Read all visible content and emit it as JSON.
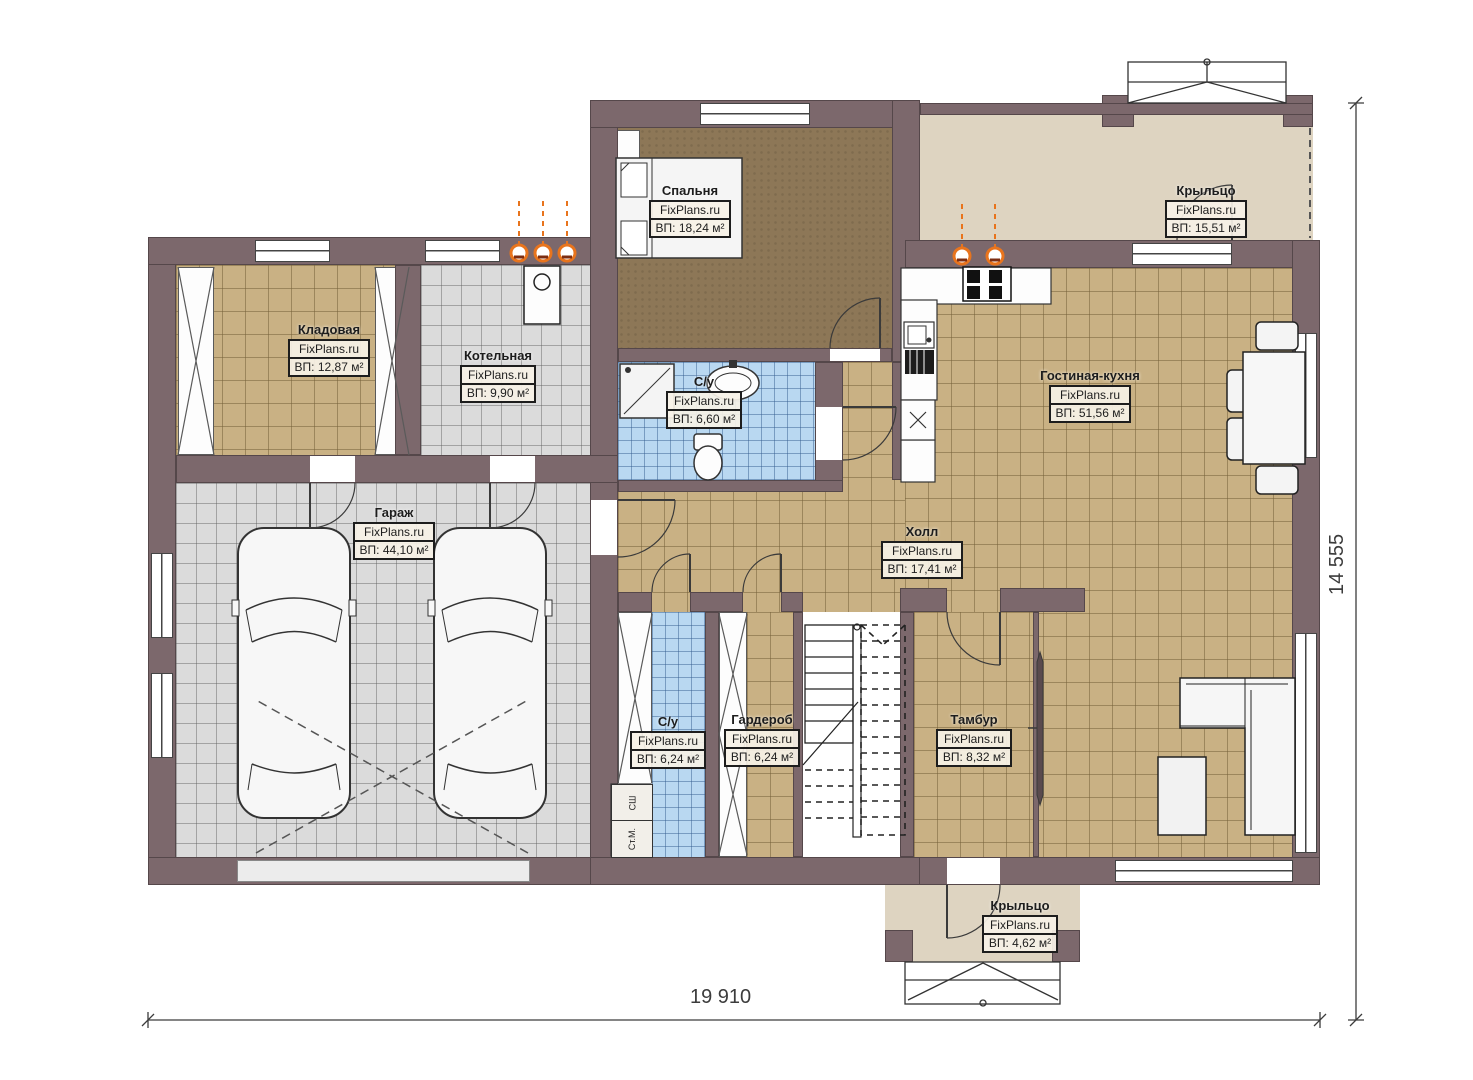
{
  "site": "FixPlans.ru",
  "rooms": {
    "bedroom": {
      "name": "Спальня",
      "brand": "FixPlans.ru",
      "area": "ВП: 18,24 м²"
    },
    "porch_top": {
      "name": "Крыльцо",
      "brand": "FixPlans.ru",
      "area": "ВП: 15,51 м²"
    },
    "storage": {
      "name": "Кладовая",
      "brand": "FixPlans.ru",
      "area": "ВП: 12,87 м²"
    },
    "boiler": {
      "name": "Котельная",
      "brand": "FixPlans.ru",
      "area": "ВП: 9,90 м²"
    },
    "bath_top": {
      "name": "С/у",
      "brand": "FixPlans.ru",
      "area": "ВП: 6,60 м²"
    },
    "living_kitchen": {
      "name": "Гостиная-кухня",
      "brand": "FixPlans.ru",
      "area": "ВП: 51,56 м²"
    },
    "garage": {
      "name": "Гараж",
      "brand": "FixPlans.ru",
      "area": "ВП: 44,10 м²"
    },
    "hall": {
      "name": "Холл",
      "brand": "FixPlans.ru",
      "area": "ВП: 17,41 м²"
    },
    "bath_bottom": {
      "name": "С/у",
      "brand": "FixPlans.ru",
      "area": "ВП: 6,24 м²"
    },
    "wardrobe": {
      "name": "Гардероб",
      "brand": "FixPlans.ru",
      "area": "ВП: 6,24 м²"
    },
    "vestibule": {
      "name": "Тамбур",
      "brand": "FixPlans.ru",
      "area": "ВП: 8,32 м²"
    },
    "porch_bottom": {
      "name": "Крыльцо",
      "brand": "FixPlans.ru",
      "area": "ВП: 4,62 м²"
    }
  },
  "appliances": {
    "dryer": "СШ",
    "washer": "Ст.М."
  },
  "dimensions": {
    "bottom": "19 910",
    "right": "14 555"
  },
  "colors": {
    "wall": "#7c686c",
    "floor_tan": "#c9b184",
    "floor_gray": "#dbdbdb",
    "floor_blue": "#b9d8f1",
    "floor_carpet": "#8d7757",
    "porch": "#ded4c1",
    "radiator": "#e8741d"
  }
}
